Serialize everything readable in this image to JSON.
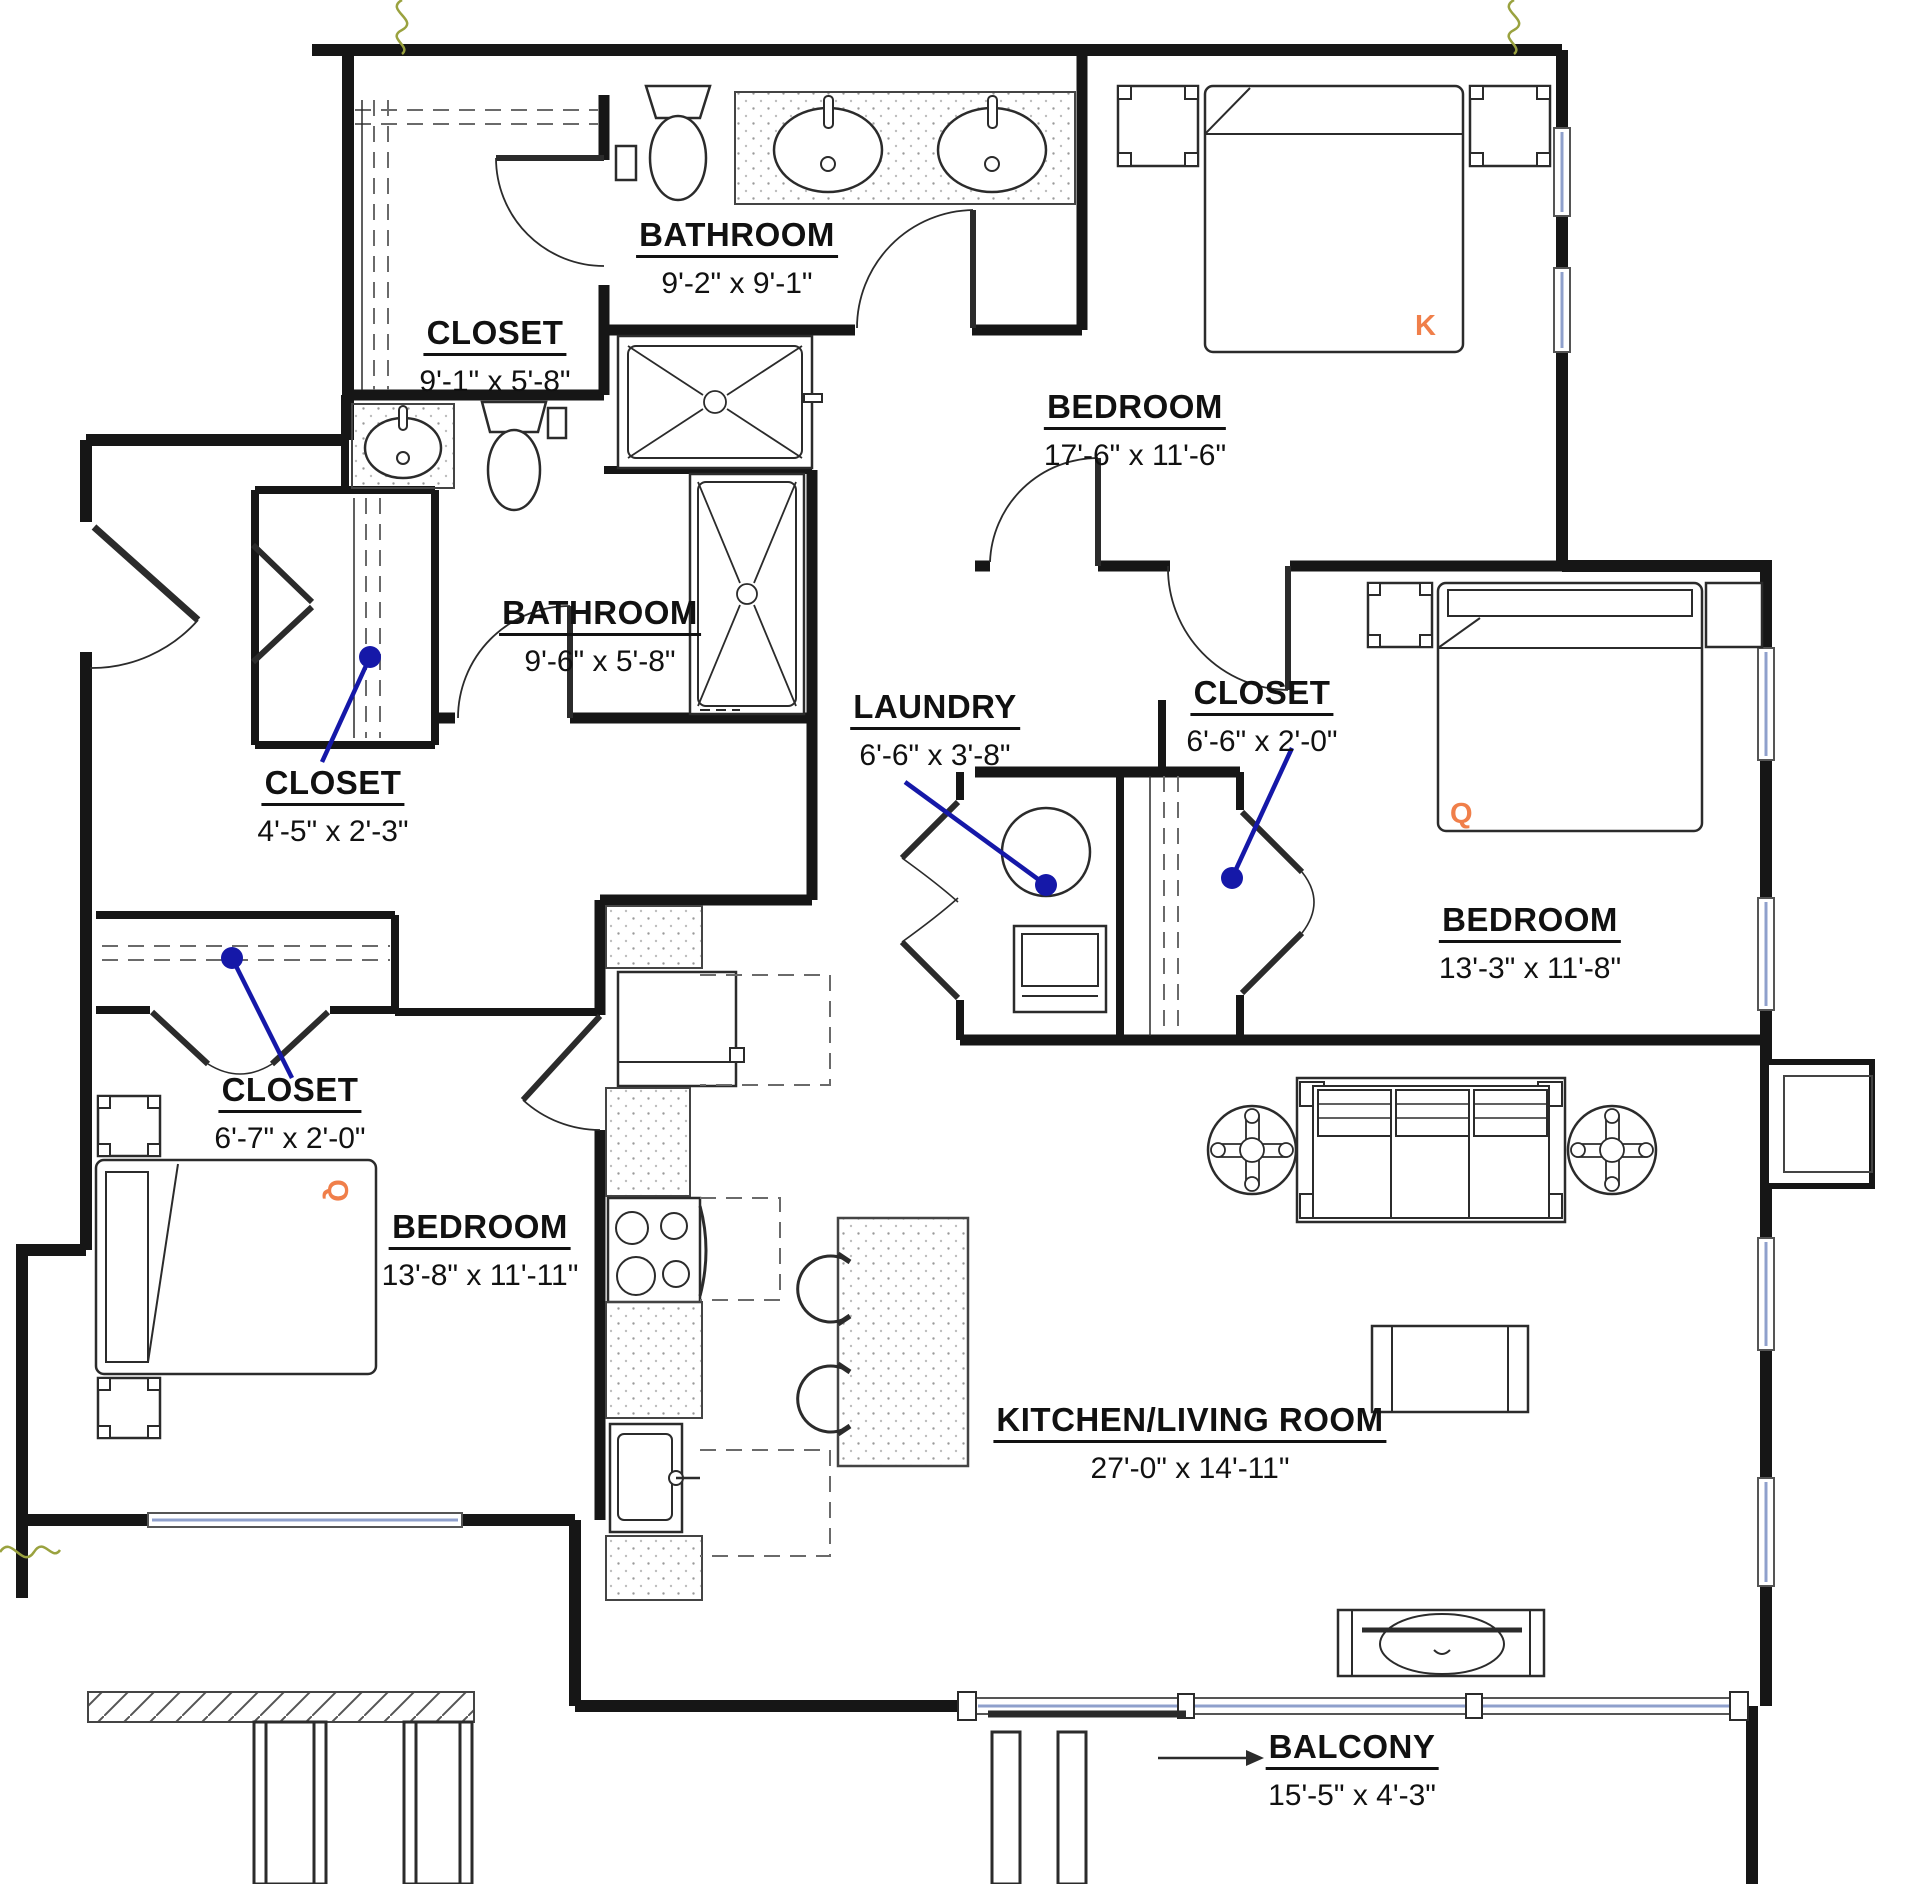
{
  "drawing_type": "apartment floor plan",
  "rooms": [
    {
      "name": "BATHROOM",
      "dims": "9'-2\" x 9'-1\""
    },
    {
      "name": "CLOSET",
      "dims": "9'-1\" x 5'-8\""
    },
    {
      "name": "BEDROOM",
      "dims": "17'-6\" x 11'-6\""
    },
    {
      "name": "BATHROOM",
      "dims": "9'-6\" x 5'-8\""
    },
    {
      "name": "LAUNDRY",
      "dims": "6'-6\" x 3'-8\""
    },
    {
      "name": "CLOSET",
      "dims": "6'-6\" x 2'-0\""
    },
    {
      "name": "CLOSET",
      "dims": "4'-5\" x 2'-3\""
    },
    {
      "name": "BEDROOM",
      "dims": "13'-3\" x 11'-8\""
    },
    {
      "name": "CLOSET",
      "dims": "6'-7\" x 2'-0\""
    },
    {
      "name": "BEDROOM",
      "dims": "13'-8\" x 11'-11\""
    },
    {
      "name": "KITCHEN/LIVING ROOM",
      "dims": "27'-0\" x 14'-11\""
    },
    {
      "name": "BALCONY",
      "dims": "15'-5\" x 4'-3\""
    }
  ],
  "bed_markers": [
    {
      "letter": "K",
      "meaning": "king bed"
    },
    {
      "letter": "Q",
      "meaning": "queen bed"
    },
    {
      "letter": "Q",
      "meaning": "queen bed"
    }
  ],
  "colors": {
    "wall_black": "#161616",
    "bed_marker_orange": "#f07f4a",
    "leader_blue": "#1518a8",
    "break_mark_green": "#9aa23f",
    "window_blue": "#8fa0cc"
  }
}
